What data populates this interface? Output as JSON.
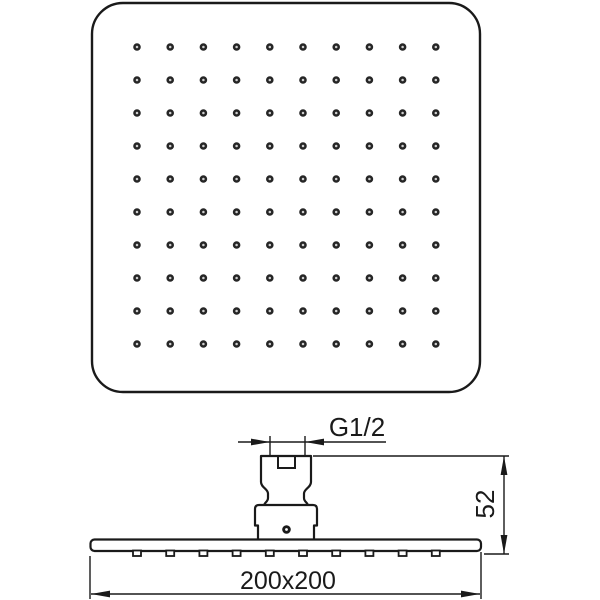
{
  "drawing": {
    "kind": "shower-head-technical-drawing",
    "background_color": "#ffffff",
    "line_color": "#1a1a1a",
    "front_view": {
      "description": "square shower head face",
      "nozzle_grid": {
        "rows": 10,
        "cols": 10
      },
      "nozzle_color": "#262626",
      "nozzle_center_color": "#cfcfcf"
    },
    "side_view": {
      "description": "shower head side profile with connector",
      "nozzle_tab_count": 10
    },
    "dimensions": {
      "thread": {
        "label": "G1/2"
      },
      "height": {
        "label": "52"
      },
      "size": {
        "label": "200x200"
      }
    }
  }
}
